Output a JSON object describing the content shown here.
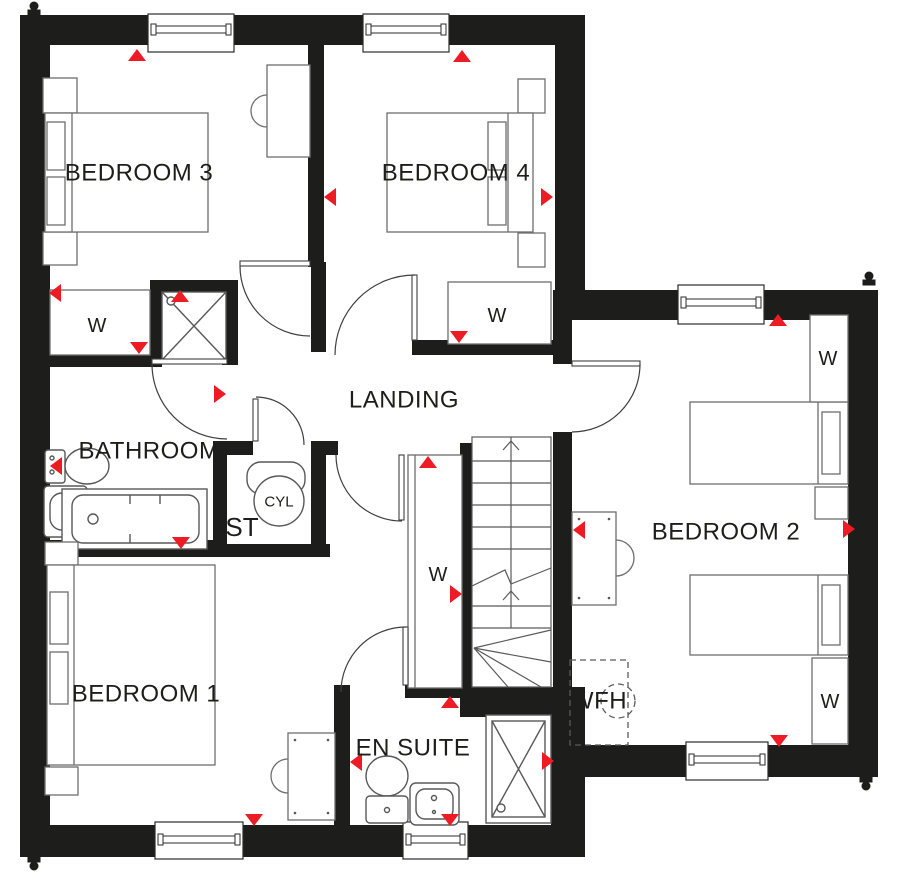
{
  "plan": {
    "title": "Upper floor plan",
    "rooms": {
      "bedroom3": "BEDROOM 3",
      "bedroom4": "BEDROOM 4",
      "bedroom2": "BEDROOM 2",
      "bedroom1": "BEDROOM 1",
      "bathroom": "BATHROOM",
      "landing": "LANDING",
      "store": "ST",
      "cylinder": "CYL",
      "ensuite": "EN SUITE",
      "wfh": "WFH"
    },
    "wardrobe_label": "W",
    "colors": {
      "wall": "#1d1d1b",
      "marker_red": "#ed1c24",
      "furniture_line": "#6e6e6e",
      "background": "#ffffff"
    }
  }
}
